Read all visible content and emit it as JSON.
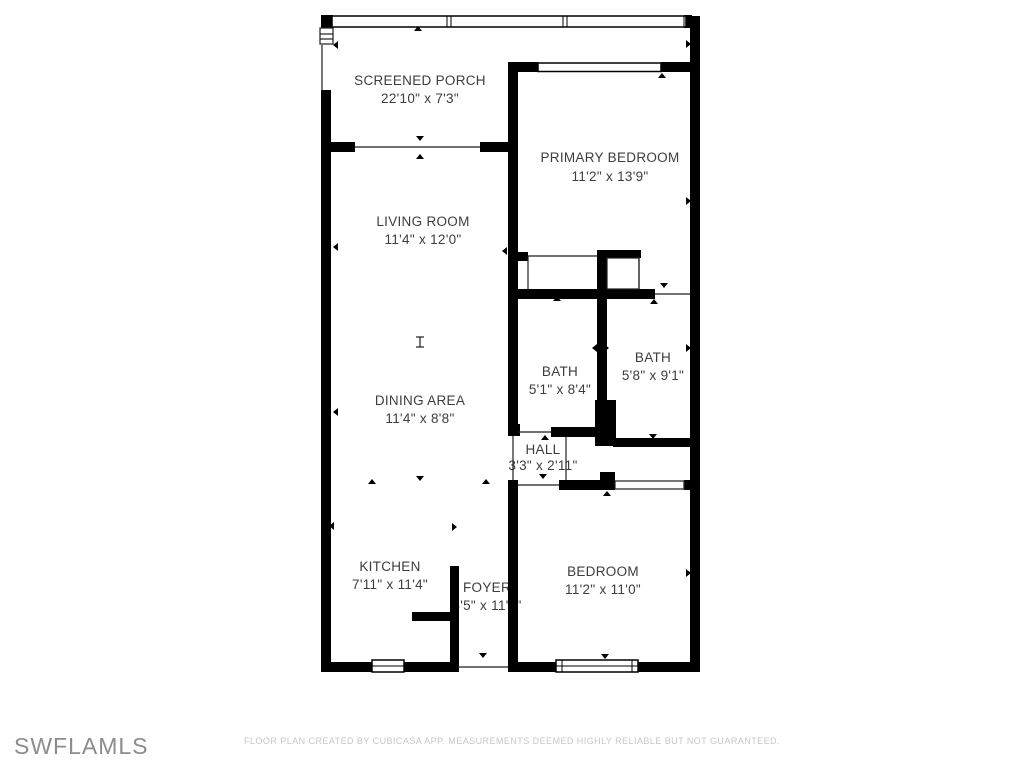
{
  "rooms": {
    "screened_porch": {
      "name": "SCREENED PORCH",
      "dims": "22'10\" x 7'3\""
    },
    "primary_bedroom": {
      "name": "PRIMARY BEDROOM",
      "dims": "11'2\" x 13'9\""
    },
    "living_room": {
      "name": "LIVING ROOM",
      "dims": "11'4\" x 12'0\""
    },
    "dining_area": {
      "name": "DINING AREA",
      "dims": "11'4\" x 8'8\""
    },
    "bath_1": {
      "name": "BATH",
      "dims": "5'1\" x 8'4\""
    },
    "bath_2": {
      "name": "BATH",
      "dims": "5'8\" x 9'1\""
    },
    "hall": {
      "name": "HALL",
      "dims": "3'3\" x 2'11\""
    },
    "kitchen": {
      "name": "KITCHEN",
      "dims": "7'11\" x 11'4\""
    },
    "foyer": {
      "name": "FOYER",
      "dims": "3'5\" x 11'4\""
    },
    "bedroom": {
      "name": "BEDROOM",
      "dims": "11'2\" x 11'0\""
    }
  },
  "footer": {
    "watermark": "SWFLAMLS",
    "disclaimer": "FLOOR PLAN CREATED BY CUBICASA APP. MEASUREMENTS DEEMED HIGHLY RELIABLE BUT NOT GUARANTEED."
  },
  "colors": {
    "wall": "#000000",
    "label_text": "#3d3d3d",
    "watermark": "#8c8c8c",
    "disclaimer": "#c7c7c7",
    "background": "#ffffff"
  }
}
